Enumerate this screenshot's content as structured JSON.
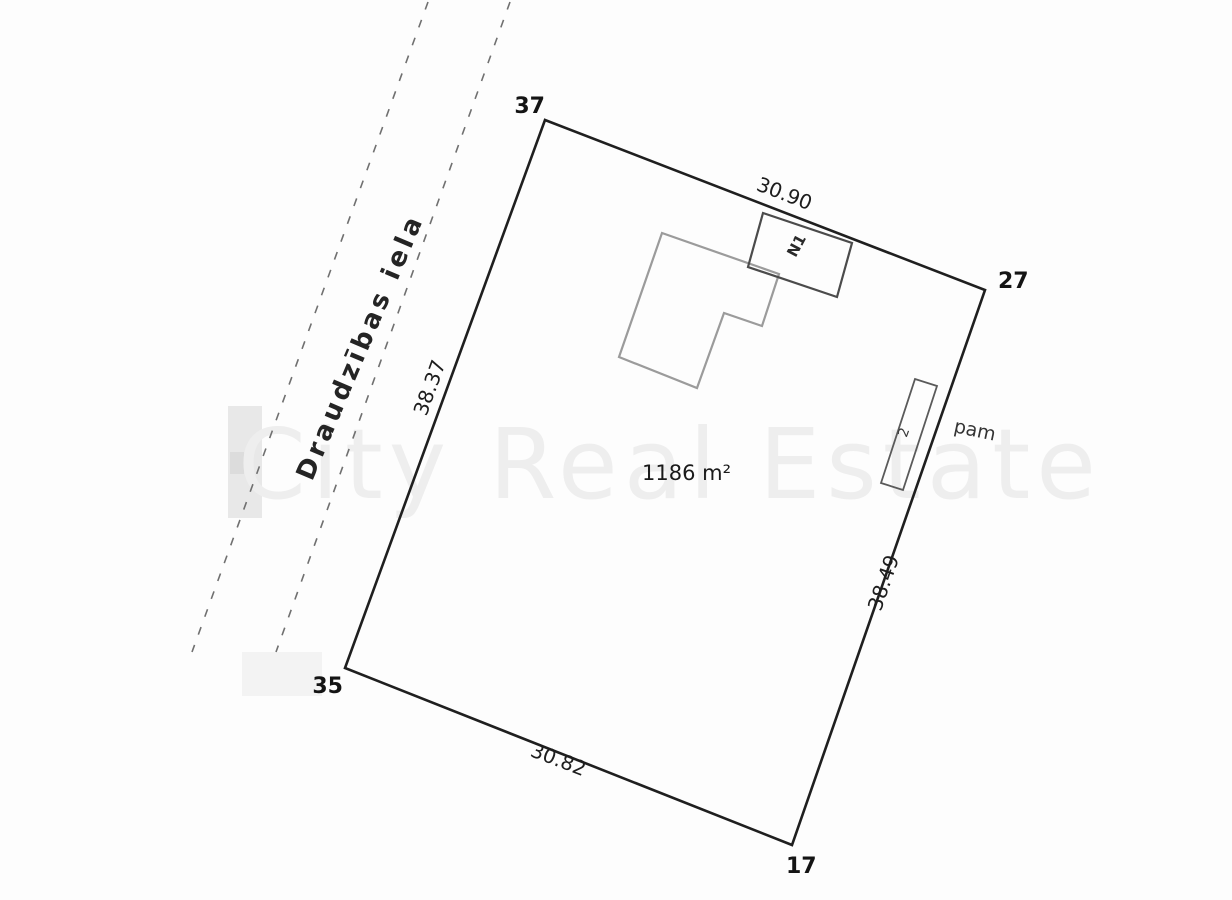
{
  "plan": {
    "street": {
      "name": "Draudzības iela"
    },
    "parcel": {
      "area_label": "1186 m²",
      "corners": [
        {
          "position": "north",
          "label": "37"
        },
        {
          "position": "east",
          "label": "27"
        },
        {
          "position": "south",
          "label": "17"
        },
        {
          "position": "west",
          "label": "35"
        }
      ],
      "sides": [
        {
          "side": "top",
          "length": "30.90"
        },
        {
          "side": "right",
          "length": "38.49"
        },
        {
          "side": "bottom",
          "length": "30.82"
        },
        {
          "side": "left",
          "length": "38.37"
        }
      ]
    },
    "structures": {
      "annex_label": "N1",
      "foundation_mark": "2",
      "foundation_label": "pam"
    },
    "watermark": {
      "text": "City Real Estate"
    },
    "colors": {
      "background": "#fdfdfd",
      "boundary_ink": "#1f1f1f",
      "building_outline": "#9b9b9b",
      "annex_outline": "#4b4b4b",
      "foundation_outline": "#5a5a5a",
      "street_dash": "#707070",
      "watermark_gray": "#eeeeee"
    }
  }
}
